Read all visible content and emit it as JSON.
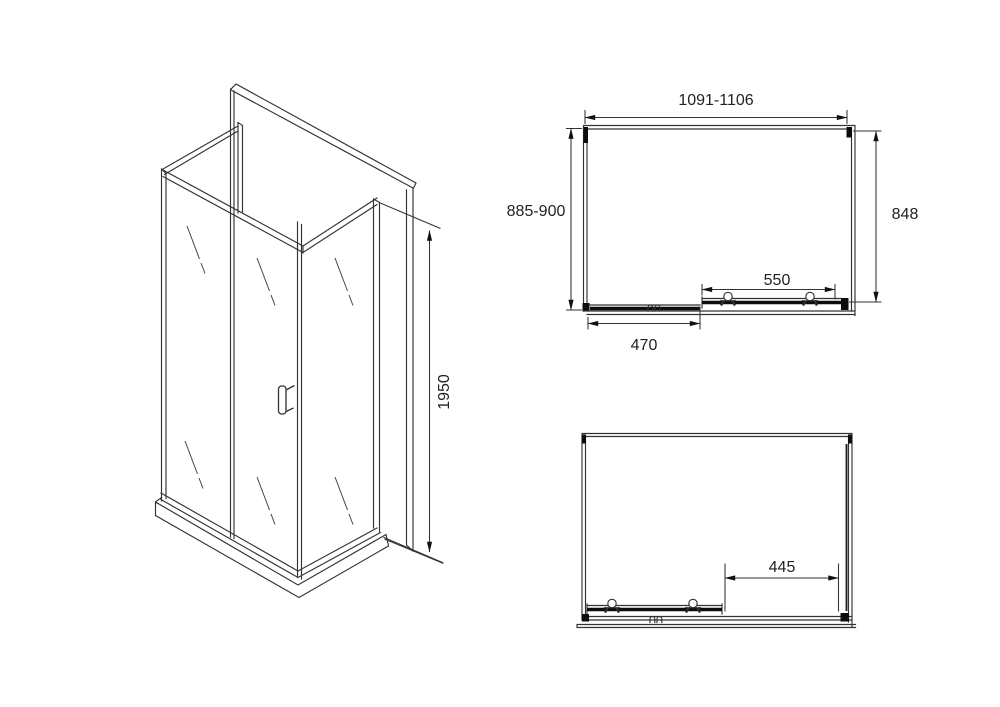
{
  "drawing": {
    "isometric": {
      "height": "1950"
    },
    "top_plan": {
      "width_range": "1091-1106",
      "depth_range": "885-900",
      "inner_depth": "848",
      "sliding_door_width": "550",
      "fixed_panel_width": "470"
    },
    "side_plan": {
      "opening_width": "445"
    }
  },
  "colors": {
    "background": "#ffffff",
    "line": "#333333",
    "line_heavy": "#0d0d0d",
    "text": "#222222"
  }
}
